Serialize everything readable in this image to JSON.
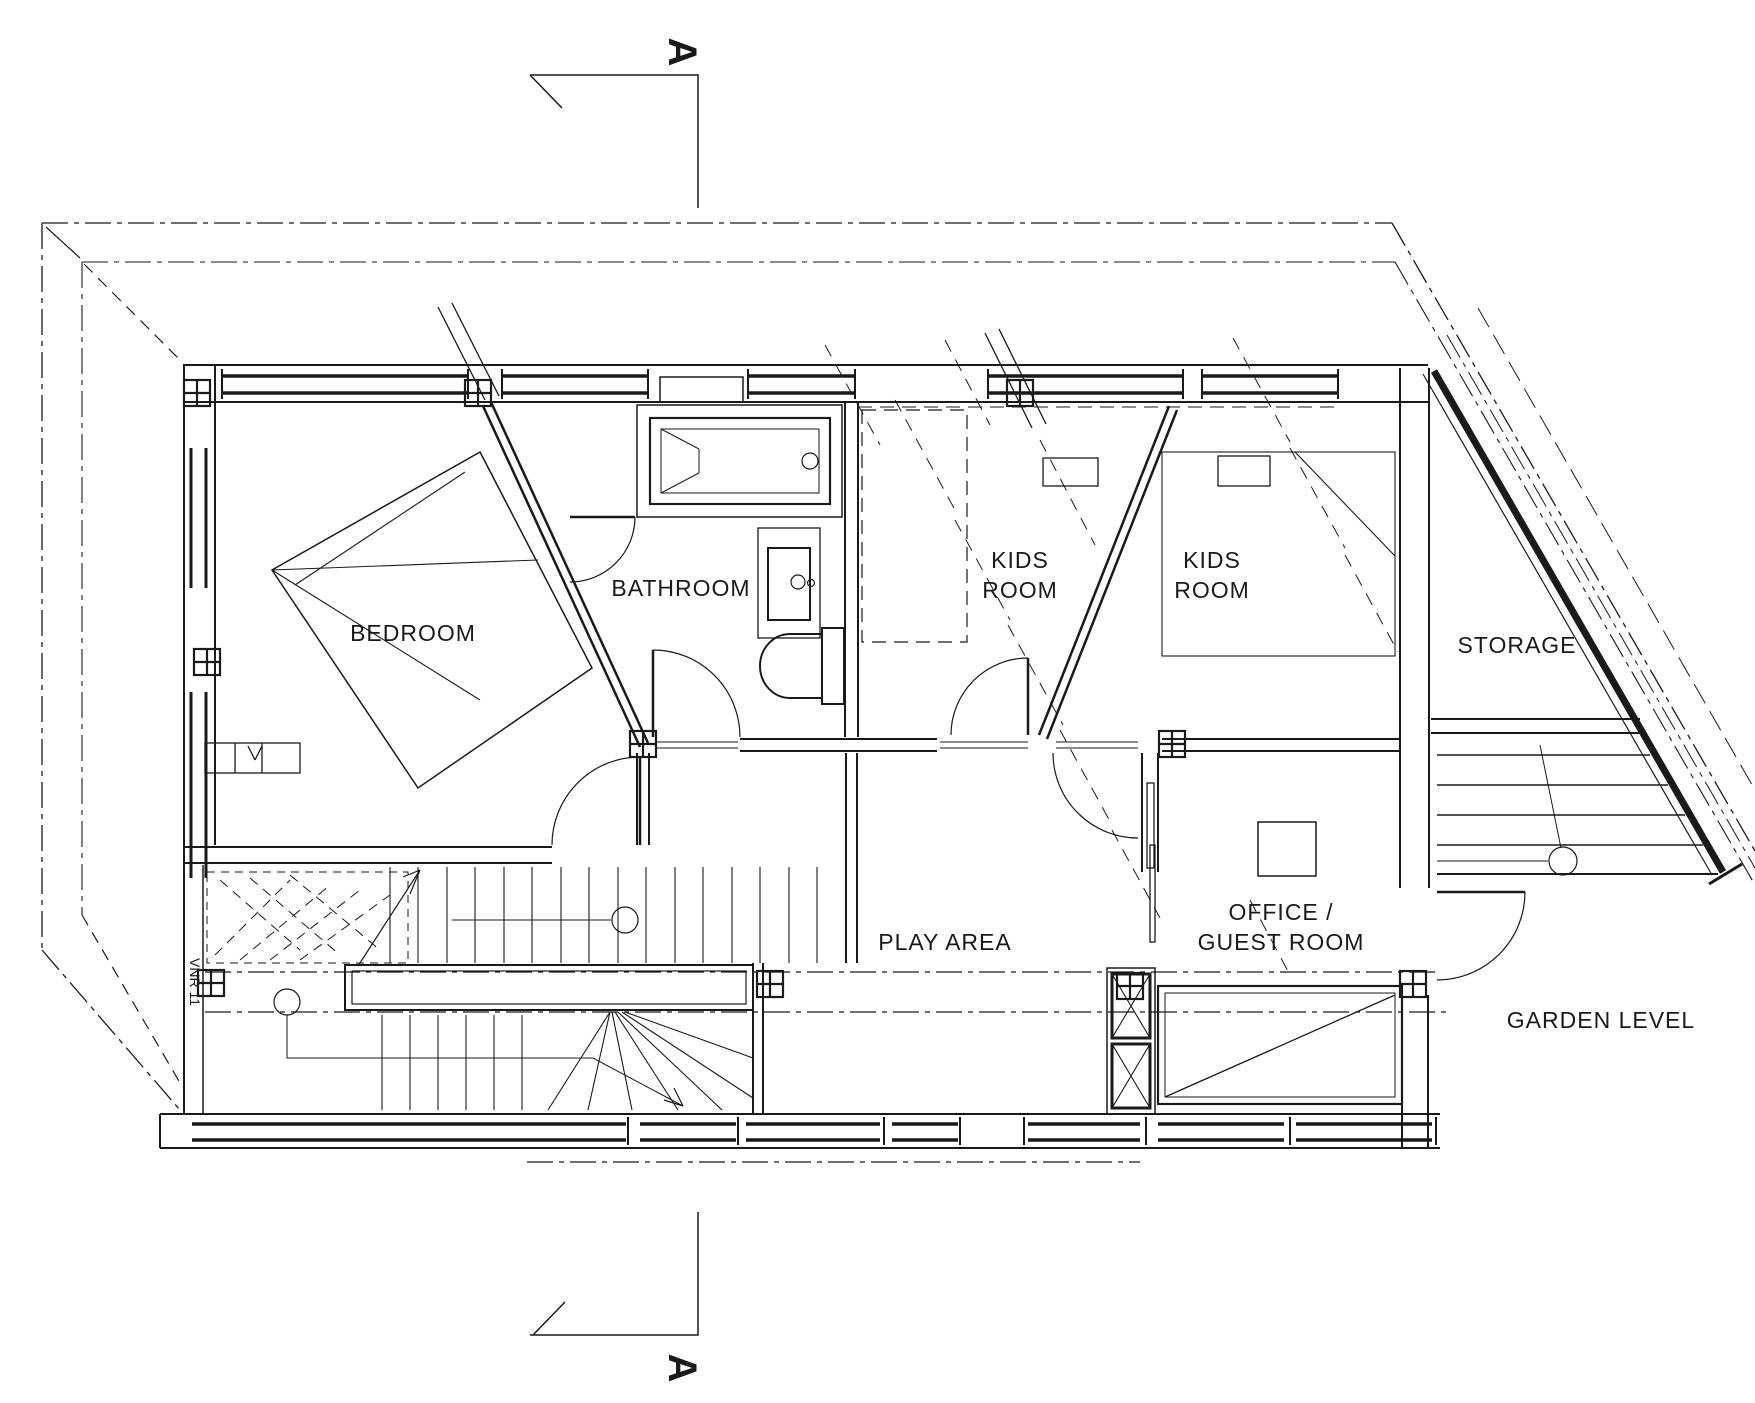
{
  "drawing": {
    "type": "architectural-floor-plan",
    "level_name": "GARDEN LEVEL",
    "section_marker": {
      "top": "A",
      "bottom": "A"
    },
    "rooms": {
      "bedroom": {
        "label": "BEDROOM"
      },
      "bathroom": {
        "label": "BATHROOM"
      },
      "kids_room_1": {
        "line1": "KIDS",
        "line2": "ROOM"
      },
      "kids_room_2": {
        "line1": "KIDS",
        "line2": "ROOM"
      },
      "storage": {
        "label": "STORAGE"
      },
      "play_area": {
        "label": "PLAY AREA"
      },
      "office_guest": {
        "line1": "OFFICE /",
        "line2": "GUEST ROOM"
      }
    },
    "annotations": {
      "garden_level": "GARDEN LEVEL",
      "stair_note": "VNR 11"
    },
    "colors": {
      "line": "#1a1a1a",
      "background": "#ffffff"
    }
  }
}
